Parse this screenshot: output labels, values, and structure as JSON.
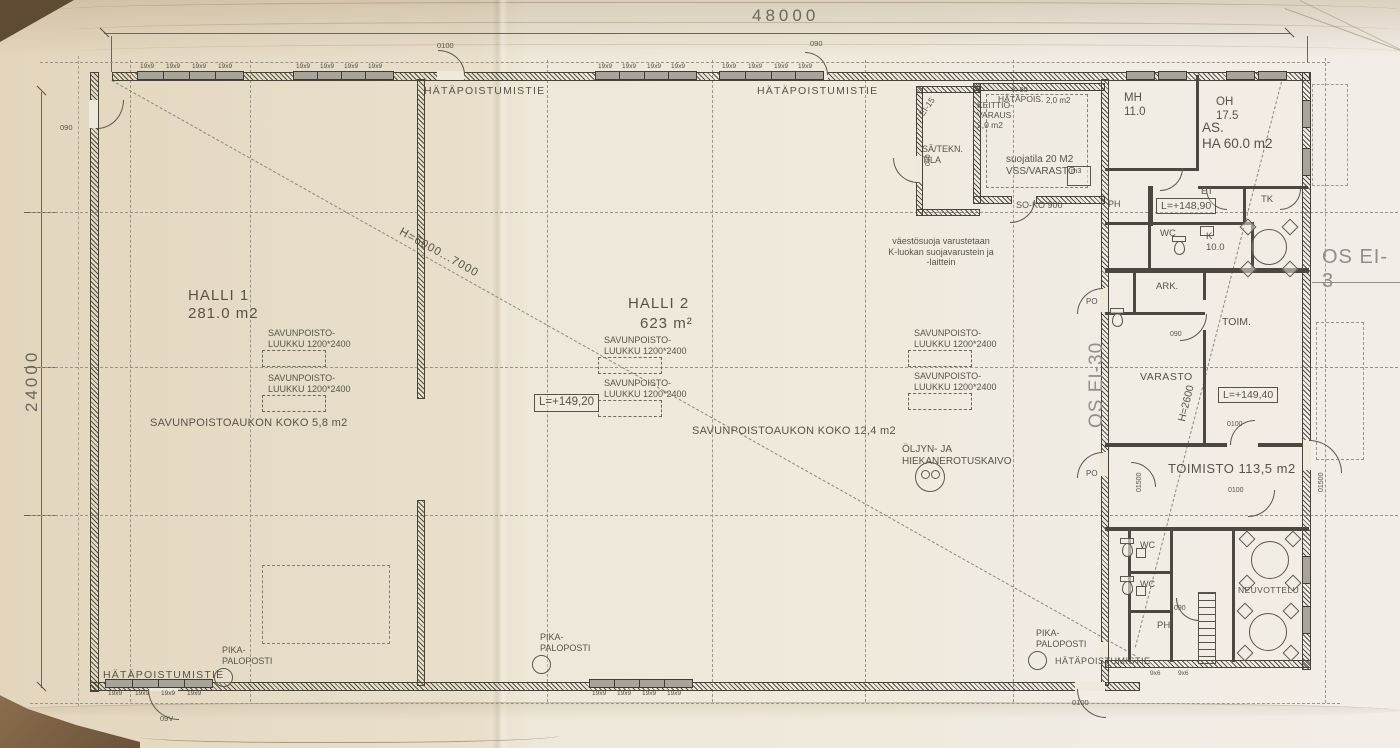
{
  "drawing_title": "Hall building floor plan",
  "dimensions": {
    "top": "48000",
    "left": "24000"
  },
  "window_mark": "19x9",
  "windows_top_x": [
    140,
    166,
    192,
    218,
    296,
    320,
    344,
    368,
    598,
    622,
    647,
    671,
    722,
    748,
    774,
    798
  ],
  "windows_bottom_x": [
    108,
    135,
    161,
    187,
    592,
    617,
    642,
    667
  ],
  "smoke_vents": {
    "line1": "SAVUNPOISTO-",
    "line2": "LUUKKU 1200*2400",
    "positions": [
      [
        262,
        328
      ],
      [
        262,
        373
      ],
      [
        598,
        335
      ],
      [
        598,
        378
      ],
      [
        908,
        328
      ],
      [
        908,
        371
      ]
    ]
  },
  "fire_posts": {
    "line1": "PIKA-",
    "line2": "PALOPOSTI",
    "positions": [
      [
        222,
        645
      ],
      [
        540,
        632
      ],
      [
        1036,
        628
      ]
    ]
  },
  "labels": [
    {
      "n": "dim-width",
      "t": "48000",
      "x": 752,
      "y": 6,
      "fs": 17,
      "ls": 4,
      "col": "#6a675f"
    },
    {
      "n": "dim-height",
      "t": "24000",
      "x": 22,
      "y": 412,
      "fs": 17,
      "ls": 3,
      "rot": -90,
      "col": "#6a675f"
    },
    {
      "n": "room-halli1",
      "t": "HALLI 1\n281.0 m2",
      "x": 188,
      "y": 287,
      "fs": 15,
      "ls": 1
    },
    {
      "n": "room-halli2",
      "t": "HALLI 2",
      "x": 628,
      "y": 295,
      "fs": 15,
      "ls": 1
    },
    {
      "n": "room-halli2-area",
      "t": "623 m²",
      "x": 640,
      "y": 315,
      "fs": 15,
      "ls": 1
    },
    {
      "n": "smoke-area-1",
      "t": "SAVUNPOISTOAUKON KOKO 5,8 m2",
      "x": 150,
      "y": 417,
      "fs": 11,
      "ls": 0.3
    },
    {
      "n": "smoke-area-2",
      "t": "SAVUNPOISTOAUKON KOKO 12,4 m2",
      "x": 692,
      "y": 425,
      "fs": 11,
      "ls": 0.3
    },
    {
      "n": "level-center",
      "t": "L=+149,20",
      "x": 534,
      "y": 394,
      "fs": 11.5,
      "box": 1
    },
    {
      "n": "height-note-halls",
      "t": "H=6000...7000",
      "x": 403,
      "y": 226,
      "fs": 11.5,
      "rot": 29,
      "ls": 1
    },
    {
      "n": "vss-note",
      "t": "väestösuoja varustetaan\nK-luokan suojavarustein ja\n-laittein",
      "x": 876,
      "y": 236,
      "fs": 9,
      "ta": "center",
      "w": 130
    },
    {
      "n": "oil-separator",
      "t": "ÖLJYN- JA\nHIEKANEROTUSKAIVO",
      "x": 902,
      "y": 444,
      "fs": 10
    },
    {
      "n": "exit-top-left",
      "t": "HÄTÄPOISTUMISTIE",
      "x": 424,
      "y": 85,
      "fs": 10.5,
      "ls": 1.2
    },
    {
      "n": "exit-top-right",
      "t": "HÄTÄPOISTUMISTIE",
      "x": 757,
      "y": 85,
      "fs": 10.5,
      "ls": 1.2
    },
    {
      "n": "exit-bottom-left",
      "t": "HÄTÄPOISTUMISTIE",
      "x": 103,
      "y": 669,
      "fs": 10.5,
      "ls": 1.2
    },
    {
      "n": "exit-bottom-right",
      "t": "HÄTÄPOISTUMISTIE",
      "x": 1055,
      "y": 656,
      "fs": 9,
      "ls": 0.5
    },
    {
      "n": "room-mh",
      "t": "MH\n11.0",
      "x": 1124,
      "y": 92,
      "fs": 11.5
    },
    {
      "n": "room-oh",
      "t": "OH\n17.5",
      "x": 1216,
      "y": 96,
      "fs": 11.5
    },
    {
      "n": "room-as",
      "t": "AS.\nHA 60.0 m2",
      "x": 1202,
      "y": 120,
      "fs": 13.5
    },
    {
      "n": "room-et",
      "t": "ET",
      "x": 1201,
      "y": 186,
      "fs": 9.5
    },
    {
      "n": "level-apartment",
      "t": "L=+148,90",
      "x": 1156,
      "y": 198,
      "fs": 10.5,
      "box": 1
    },
    {
      "n": "room-tk",
      "t": "TK",
      "x": 1261,
      "y": 194,
      "fs": 9.5
    },
    {
      "n": "room-ph-top",
      "t": "PH",
      "x": 1108,
      "y": 199,
      "fs": 9
    },
    {
      "n": "room-wc-top",
      "t": "WC",
      "x": 1160,
      "y": 228,
      "fs": 9.5
    },
    {
      "n": "room-k",
      "t": "K\n10.0",
      "x": 1206,
      "y": 231,
      "fs": 9.5
    },
    {
      "n": "room-ark",
      "t": "ARK.",
      "x": 1156,
      "y": 281,
      "fs": 9.5
    },
    {
      "n": "room-toim",
      "t": "TOIM.",
      "x": 1222,
      "y": 316,
      "fs": 10.5
    },
    {
      "n": "room-varasto",
      "t": "VARASTO",
      "x": 1140,
      "y": 371,
      "fs": 10.5,
      "ls": 0.5
    },
    {
      "n": "height-note-office",
      "t": "H=2600",
      "x": 1176,
      "y": 420,
      "fs": 10.5,
      "rot": -76
    },
    {
      "n": "level-office",
      "t": "L=+149,40",
      "x": 1218,
      "y": 387,
      "fs": 10.5,
      "box": 1
    },
    {
      "n": "room-toimisto",
      "t": "TOIMISTO 113,5 m2",
      "x": 1168,
      "y": 461,
      "fs": 13,
      "ls": 0.5
    },
    {
      "n": "room-wc-1",
      "t": "WC",
      "x": 1140,
      "y": 540,
      "fs": 9
    },
    {
      "n": "room-wc-2",
      "t": "WC",
      "x": 1140,
      "y": 579,
      "fs": 9
    },
    {
      "n": "room-ph-bottom",
      "t": "PH",
      "x": 1157,
      "y": 620,
      "fs": 9.5
    },
    {
      "n": "room-neuvottelu",
      "t": "NEUVOTTELU",
      "x": 1238,
      "y": 585,
      "fs": 8.5,
      "ls": 0.4
    },
    {
      "n": "firewall-class",
      "t": "OS EI-30",
      "x": 1086,
      "y": 428,
      "fs": 19,
      "rot": -90,
      "col": "#91908a",
      "ls": 1
    },
    {
      "n": "section-class",
      "t": "OS EI-3",
      "x": 1322,
      "y": 246,
      "fs": 20,
      "col": "#8f8e88",
      "ls": 1
    },
    {
      "n": "tekn-class",
      "t": "EI-15",
      "x": 917,
      "y": 112,
      "fs": 8.5,
      "rot": -55
    },
    {
      "n": "room-tekn",
      "t": "SÄ/TEKN.\nTILA",
      "x": 922,
      "y": 144,
      "fs": 9
    },
    {
      "n": "vss-k90",
      "t": "K-90",
      "x": 1012,
      "y": 86,
      "fs": 7.5
    },
    {
      "n": "vss-hatch",
      "t": "HÄTÄPOIS.",
      "x": 998,
      "y": 94,
      "fs": 8.5
    },
    {
      "n": "vss-hatch-area",
      "t": "2,0 m2",
      "x": 1046,
      "y": 96,
      "fs": 8
    },
    {
      "n": "keittio-varaus",
      "t": "KEITTIÖ-\nVARAUS\n2,0 m2",
      "x": 977,
      "y": 100,
      "fs": 8.5
    },
    {
      "n": "vss-room",
      "t": "suojatila 20 M2\nVSS/VARASTO",
      "x": 1006,
      "y": 154,
      "fs": 10
    },
    {
      "n": "vss-m3",
      "t": "m3",
      "x": 1071,
      "y": 167,
      "fs": 7.5
    },
    {
      "n": "soko",
      "t": "SO-KO 900",
      "x": 1016,
      "y": 200,
      "fs": 9
    },
    {
      "n": "door-0100-top",
      "t": "0100",
      "x": 437,
      "y": 42,
      "fs": 7.5
    },
    {
      "n": "door-090-top",
      "t": "090",
      "x": 810,
      "y": 40,
      "fs": 7.5
    },
    {
      "n": "door-090-left",
      "t": "090",
      "x": 60,
      "y": 124,
      "fs": 7.5
    },
    {
      "n": "door-090-tekn",
      "t": "090",
      "x": 925,
      "y": 166,
      "fs": 7,
      "rot": -90
    },
    {
      "n": "door-09v-bottom",
      "t": "09V",
      "x": 160,
      "y": 715,
      "fs": 7.5
    },
    {
      "n": "door-0100-bottom",
      "t": "0100",
      "x": 1072,
      "y": 699,
      "fs": 7.5
    },
    {
      "n": "door-po-1",
      "t": "PO",
      "x": 1086,
      "y": 297,
      "fs": 8
    },
    {
      "n": "door-po-2",
      "t": "PO",
      "x": 1086,
      "y": 469,
      "fs": 8
    },
    {
      "n": "door-090-toim",
      "t": "090",
      "x": 1170,
      "y": 331,
      "fs": 7
    },
    {
      "n": "door-0100-varasto",
      "t": "0100",
      "x": 1227,
      "y": 421,
      "fs": 7
    },
    {
      "n": "door-01500-a",
      "t": "01500",
      "x": 1136,
      "y": 492,
      "fs": 7,
      "rot": -90
    },
    {
      "n": "door-01500-b",
      "t": "01500",
      "x": 1318,
      "y": 492,
      "fs": 7,
      "rot": -90
    },
    {
      "n": "door-0100-toimisto",
      "t": "0100",
      "x": 1228,
      "y": 487,
      "fs": 7
    },
    {
      "n": "door-090-ph",
      "t": "090",
      "x": 1174,
      "y": 605,
      "fs": 7
    },
    {
      "n": "window-9x6-a",
      "t": "9x6",
      "x": 1150,
      "y": 670,
      "fs": 6.5
    },
    {
      "n": "window-9x6-b",
      "t": "9x6",
      "x": 1178,
      "y": 670,
      "fs": 6.5
    }
  ]
}
